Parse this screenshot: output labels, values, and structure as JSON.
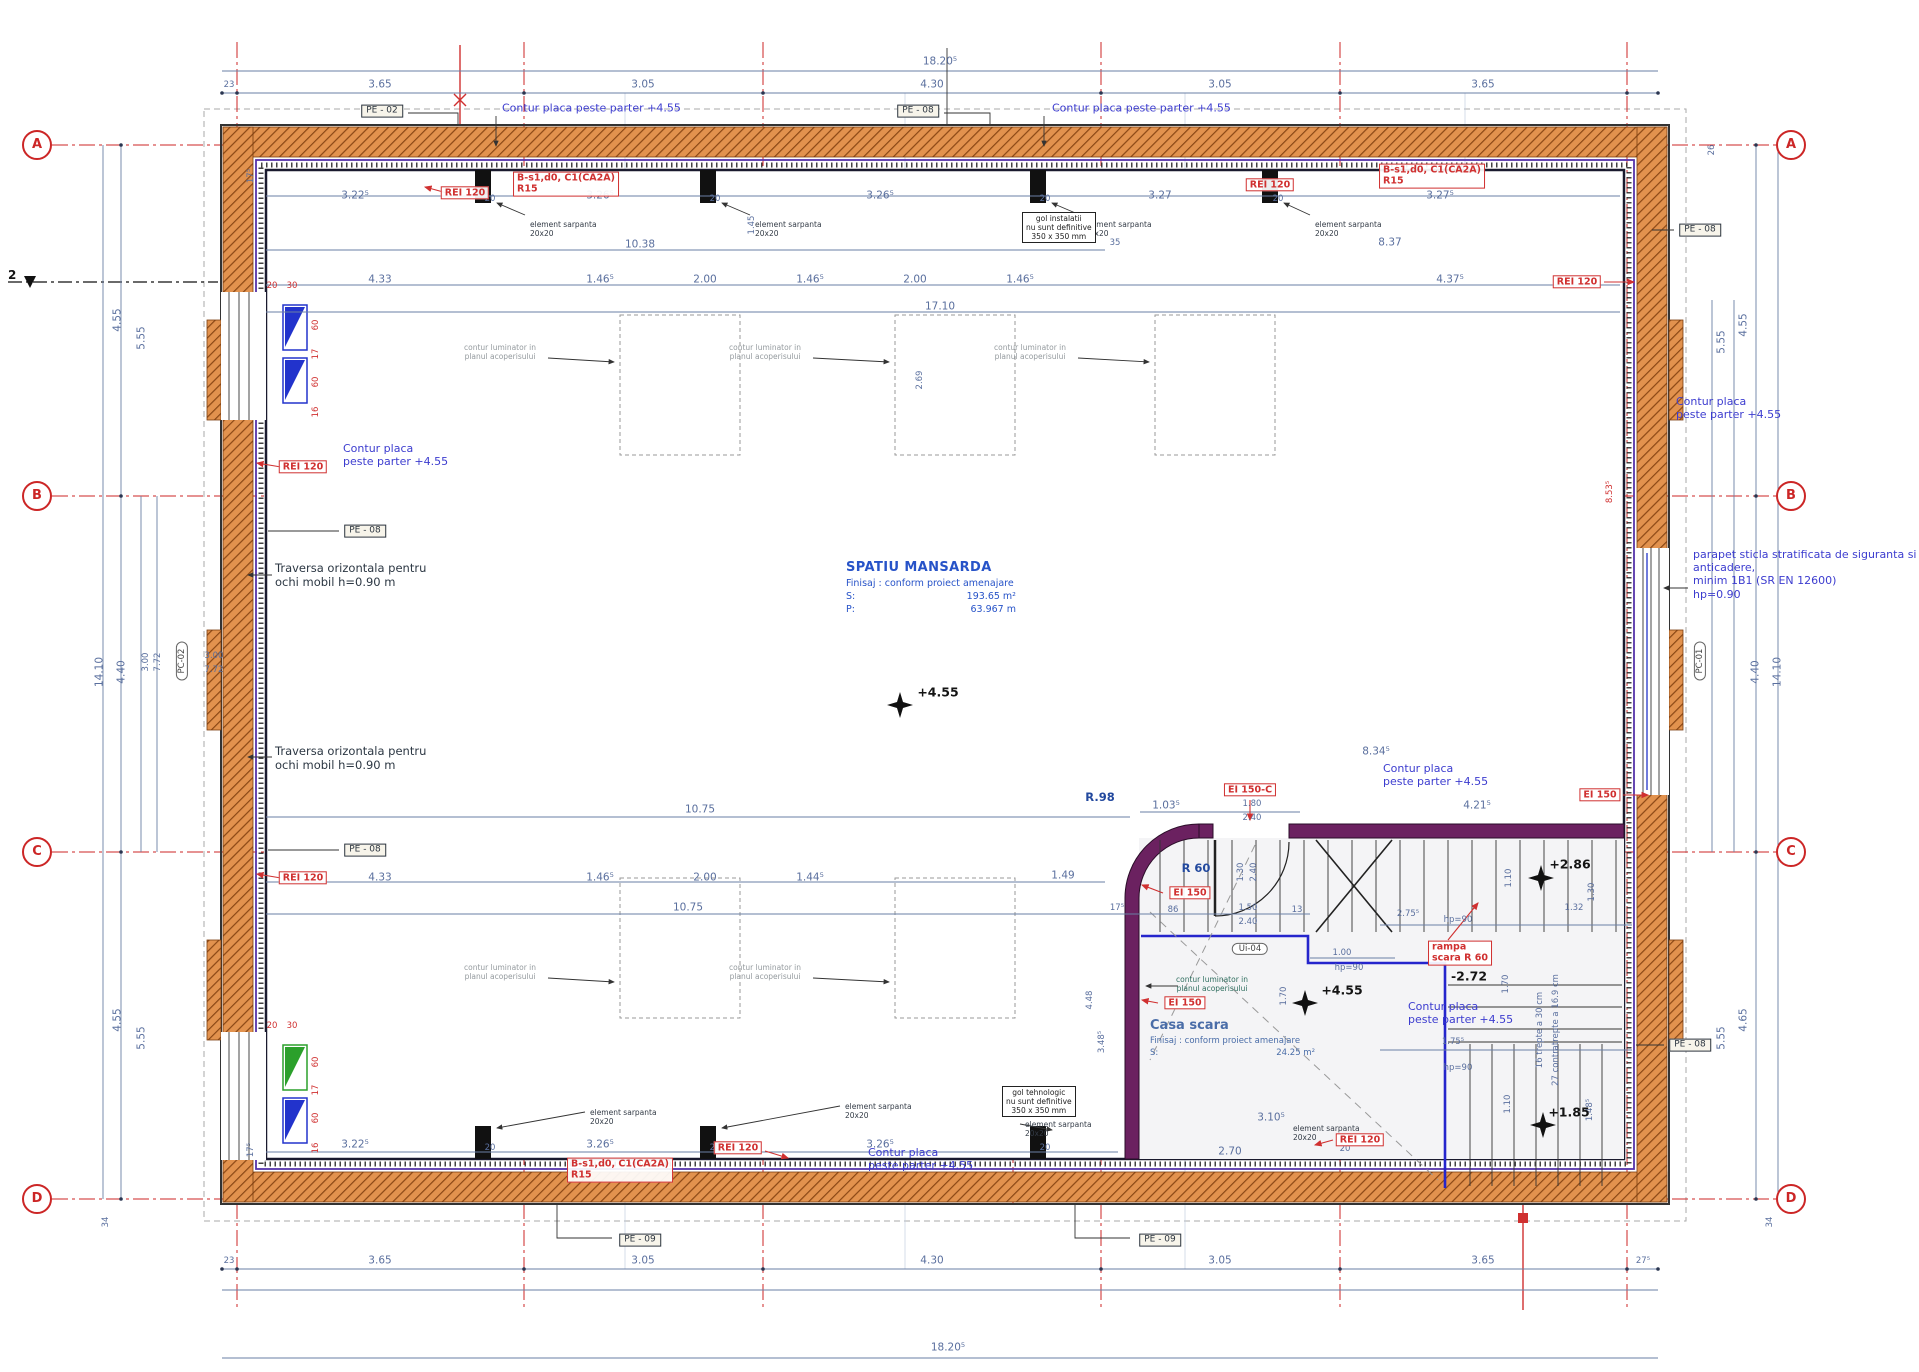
{
  "drawing": {
    "colors": {
      "wall_orange": "#e2924e",
      "wall_hatch": "#8a4715",
      "stair_purple": "#6b2160",
      "stair_blue": "#2525cc",
      "grid_red": "#cc2626",
      "dim_blue": "#5a6f9e",
      "note_blue": "#3c3ccf",
      "label_red": "#d03030"
    },
    "section_marker": {
      "label": "2"
    },
    "rooms": {
      "mansarda": {
        "title": "SPATIU MANSARDA",
        "finish": "Finisaj : conform proiect amenajare",
        "s_label": "S:",
        "s_value": "193.65 m²",
        "p_label": "P:",
        "p_value": "63.967 m"
      },
      "casa_scara": {
        "title": "Casa scara",
        "finish": "Finisaj : conform proiect amenajare",
        "s_label": "S:",
        "s_value": "24.25 m²"
      }
    },
    "grid": {
      "bubbles": [
        {
          "t": "A",
          "x": 37,
          "y": 145
        },
        {
          "t": "A",
          "x": 1791,
          "y": 145
        },
        {
          "t": "B",
          "x": 37,
          "y": 496
        },
        {
          "t": "B",
          "x": 1791,
          "y": 496
        },
        {
          "t": "C",
          "x": 37,
          "y": 852
        },
        {
          "t": "C",
          "x": 1791,
          "y": 852
        },
        {
          "t": "D",
          "x": 37,
          "y": 1199
        },
        {
          "t": "D",
          "x": 1791,
          "y": 1199
        }
      ]
    },
    "levels": [
      {
        "t": "+4.55",
        "x": 938,
        "y": 692
      },
      {
        "t": "+4.55",
        "x": 1342,
        "y": 990
      },
      {
        "t": "+2.86",
        "x": 1570,
        "y": 864
      },
      {
        "t": "+1.85",
        "x": 1569,
        "y": 1112
      },
      {
        "t": "-2.72",
        "x": 1469,
        "y": 976
      }
    ],
    "r_labels": [
      {
        "t": "R 60",
        "x": 1196,
        "y": 869
      },
      {
        "t": "R.98",
        "x": 1100,
        "y": 798
      }
    ],
    "dims": [
      {
        "t": "18.20⁵",
        "x": 940,
        "y": 62
      },
      {
        "t": "23",
        "x": 229,
        "y": 85,
        "c": "sm"
      },
      {
        "t": "3.65",
        "x": 380,
        "y": 85
      },
      {
        "t": "3.05",
        "x": 643,
        "y": 85
      },
      {
        "t": "4.30",
        "x": 932,
        "y": 85
      },
      {
        "t": "3.05",
        "x": 1220,
        "y": 85
      },
      {
        "t": "3.65",
        "x": 1483,
        "y": 85
      },
      {
        "t": "23",
        "x": 229,
        "y": 1261,
        "c": "sm"
      },
      {
        "t": "3.65",
        "x": 380,
        "y": 1261
      },
      {
        "t": "3.05",
        "x": 643,
        "y": 1261
      },
      {
        "t": "4.30",
        "x": 932,
        "y": 1261
      },
      {
        "t": "3.05",
        "x": 1220,
        "y": 1261
      },
      {
        "t": "3.65",
        "x": 1483,
        "y": 1261
      },
      {
        "t": "27⁵",
        "x": 1643,
        "y": 1261,
        "c": "sm"
      },
      {
        "t": "18.20⁵",
        "x": 948,
        "y": 1348
      },
      {
        "t": "4.55",
        "x": 118,
        "y": 320,
        "r": 1
      },
      {
        "t": "5.55",
        "x": 142,
        "y": 338,
        "r": 1
      },
      {
        "t": "14.10",
        "x": 100,
        "y": 672,
        "r": 1
      },
      {
        "t": "4.40",
        "x": 122,
        "y": 672,
        "r": 1
      },
      {
        "t": "3.00",
        "x": 146,
        "y": 662,
        "r": 1,
        "c": "sm"
      },
      {
        "t": "7.72",
        "x": 158,
        "y": 662,
        "r": 1,
        "c": "sm"
      },
      {
        "t": "3.00",
        "x": 214,
        "y": 656,
        "c": "sm"
      },
      {
        "t": "7.72",
        "x": 214,
        "y": 670,
        "c": "sm"
      },
      {
        "t": "4.55",
        "x": 118,
        "y": 1020,
        "r": 1
      },
      {
        "t": "5.55",
        "x": 142,
        "y": 1038,
        "r": 1
      },
      {
        "t": "34",
        "x": 106,
        "y": 1222,
        "r": 1,
        "c": "sm"
      },
      {
        "t": "17⁵",
        "x": 251,
        "y": 176,
        "r": 1,
        "c": "sm"
      },
      {
        "t": "17⁵",
        "x": 251,
        "y": 1150,
        "r": 1,
        "c": "sm"
      },
      {
        "t": "26",
        "x": 1712,
        "y": 150,
        "r": 1,
        "c": "sm"
      },
      {
        "t": "4.55",
        "x": 1744,
        "y": 325,
        "r": 1
      },
      {
        "t": "5.55",
        "x": 1722,
        "y": 342,
        "r": 1
      },
      {
        "t": "14.10",
        "x": 1778,
        "y": 672,
        "r": 1
      },
      {
        "t": "4.40",
        "x": 1756,
        "y": 672,
        "r": 1
      },
      {
        "t": "4.65",
        "x": 1744,
        "y": 1020,
        "r": 1
      },
      {
        "t": "5.55",
        "x": 1722,
        "y": 1038,
        "r": 1
      },
      {
        "t": "34",
        "x": 1770,
        "y": 1222,
        "r": 1,
        "c": "sm"
      },
      {
        "t": "3.22⁵",
        "x": 355,
        "y": 196
      },
      {
        "t": "20",
        "x": 490,
        "y": 199,
        "c": "sm"
      },
      {
        "t": "3.26⁵",
        "x": 600,
        "y": 196
      },
      {
        "t": "20",
        "x": 715,
        "y": 199,
        "c": "sm"
      },
      {
        "t": "3.26⁵",
        "x": 880,
        "y": 196
      },
      {
        "t": "20",
        "x": 1045,
        "y": 199,
        "c": "sm"
      },
      {
        "t": "3.27",
        "x": 1160,
        "y": 196
      },
      {
        "t": "20",
        "x": 1278,
        "y": 199,
        "c": "sm"
      },
      {
        "t": "3.27⁵",
        "x": 1440,
        "y": 196
      },
      {
        "t": "10.38",
        "x": 640,
        "y": 245
      },
      {
        "t": "35",
        "x": 1115,
        "y": 243,
        "c": "sm"
      },
      {
        "t": "8.37",
        "x": 1390,
        "y": 243
      },
      {
        "t": "1.45",
        "x": 752,
        "y": 225,
        "r": 1,
        "c": "sm"
      },
      {
        "t": "4.33",
        "x": 380,
        "y": 280
      },
      {
        "t": "1.46⁵",
        "x": 600,
        "y": 280
      },
      {
        "t": "2.00",
        "x": 705,
        "y": 280
      },
      {
        "t": "1.46⁵",
        "x": 810,
        "y": 280
      },
      {
        "t": "2.00",
        "x": 915,
        "y": 280
      },
      {
        "t": "1.46⁵",
        "x": 1020,
        "y": 280
      },
      {
        "t": "4.37⁵",
        "x": 1450,
        "y": 280
      },
      {
        "t": "17.10",
        "x": 940,
        "y": 307
      },
      {
        "t": "2.69",
        "x": 920,
        "y": 380,
        "r": 1,
        "c": "sm"
      },
      {
        "t": "10.75",
        "x": 700,
        "y": 810
      },
      {
        "t": "10.75",
        "x": 688,
        "y": 908
      },
      {
        "t": "8.34⁵",
        "x": 1376,
        "y": 752
      },
      {
        "t": "4.21⁵",
        "x": 1477,
        "y": 806
      },
      {
        "t": "1.03⁵",
        "x": 1166,
        "y": 806
      },
      {
        "t": "1.80",
        "x": 1252,
        "y": 804,
        "c": "sm"
      },
      {
        "t": "2.40",
        "x": 1252,
        "y": 818,
        "c": "sm"
      },
      {
        "t": "4.33",
        "x": 380,
        "y": 878
      },
      {
        "t": "1.46⁵",
        "x": 600,
        "y": 878
      },
      {
        "t": "2.00",
        "x": 705,
        "y": 878
      },
      {
        "t": "1.44⁵",
        "x": 810,
        "y": 878
      },
      {
        "t": "1.49",
        "x": 1063,
        "y": 876
      },
      {
        "t": "17⁵",
        "x": 1117,
        "y": 908,
        "c": "sm"
      },
      {
        "t": "86",
        "x": 1173,
        "y": 910,
        "c": "sm"
      },
      {
        "t": "1.50",
        "x": 1248,
        "y": 908,
        "c": "sm"
      },
      {
        "t": "2.40",
        "x": 1248,
        "y": 922,
        "c": "sm"
      },
      {
        "t": "13",
        "x": 1297,
        "y": 910,
        "c": "sm"
      },
      {
        "t": "1.30",
        "x": 1241,
        "y": 872,
        "r": 1,
        "c": "sm"
      },
      {
        "t": "2.40",
        "x": 1254,
        "y": 872,
        "r": 1,
        "c": "sm"
      },
      {
        "t": "2.75⁵",
        "x": 1408,
        "y": 914,
        "c": "sm"
      },
      {
        "t": "hp=90",
        "x": 1458,
        "y": 920,
        "c": "sm"
      },
      {
        "t": "1.32",
        "x": 1574,
        "y": 908,
        "c": "sm"
      },
      {
        "t": "1.30",
        "x": 1592,
        "y": 892,
        "r": 1,
        "c": "sm"
      },
      {
        "t": "1.10",
        "x": 1509,
        "y": 878,
        "r": 1,
        "c": "sm"
      },
      {
        "t": "1.00",
        "x": 1342,
        "y": 953,
        "c": "sm"
      },
      {
        "t": "hp=90",
        "x": 1349,
        "y": 968,
        "c": "sm"
      },
      {
        "t": "1.70",
        "x": 1284,
        "y": 996,
        "r": 1,
        "c": "sm"
      },
      {
        "t": "1.70",
        "x": 1506,
        "y": 984,
        "r": 1,
        "c": "sm"
      },
      {
        "t": "4.48",
        "x": 1090,
        "y": 1000,
        "r": 1,
        "c": "sm"
      },
      {
        "t": "3.48⁵",
        "x": 1102,
        "y": 1042,
        "r": 1,
        "c": "sm"
      },
      {
        "t": "1.75⁵",
        "x": 1453,
        "y": 1042,
        "c": "sm"
      },
      {
        "t": "hp=90",
        "x": 1458,
        "y": 1068,
        "c": "sm"
      },
      {
        "t": "1.10",
        "x": 1508,
        "y": 1104,
        "r": 1,
        "c": "sm"
      },
      {
        "t": "1.48⁵",
        "x": 1590,
        "y": 1110,
        "r": 1,
        "c": "sm"
      },
      {
        "t": "27 contratrepte a 16.9 cm",
        "x": 1556,
        "y": 1030,
        "r": 1,
        "c": "sm"
      },
      {
        "t": "16 trepte a 30 cm",
        "x": 1540,
        "y": 1030,
        "r": 1,
        "c": "sm"
      },
      {
        "t": "3.22⁵",
        "x": 355,
        "y": 1145
      },
      {
        "t": "20",
        "x": 490,
        "y": 1148,
        "c": "sm"
      },
      {
        "t": "3.26⁵",
        "x": 600,
        "y": 1145
      },
      {
        "t": "20",
        "x": 715,
        "y": 1148,
        "c": "sm"
      },
      {
        "t": "3.26⁵",
        "x": 880,
        "y": 1145
      },
      {
        "t": "20",
        "x": 1045,
        "y": 1148,
        "c": "sm"
      },
      {
        "t": "3.10⁵",
        "x": 1271,
        "y": 1118
      },
      {
        "t": "2.70",
        "x": 1230,
        "y": 1152
      },
      {
        "t": "20",
        "x": 1345,
        "y": 1149,
        "c": "sm"
      },
      {
        "t": "20",
        "x": 272,
        "y": 286,
        "c": "rd"
      },
      {
        "t": "30",
        "x": 292,
        "y": 286,
        "c": "rd"
      },
      {
        "t": "60",
        "x": 316,
        "y": 325,
        "r": 1,
        "c": "rd"
      },
      {
        "t": "17",
        "x": 316,
        "y": 354,
        "r": 1,
        "c": "rd"
      },
      {
        "t": "60",
        "x": 316,
        "y": 382,
        "r": 1,
        "c": "rd"
      },
      {
        "t": "16",
        "x": 316,
        "y": 412,
        "r": 1,
        "c": "rd"
      },
      {
        "t": "20",
        "x": 272,
        "y": 1026,
        "c": "rd"
      },
      {
        "t": "30",
        "x": 292,
        "y": 1026,
        "c": "rd"
      },
      {
        "t": "60",
        "x": 316,
        "y": 1062,
        "r": 1,
        "c": "rd"
      },
      {
        "t": "17",
        "x": 316,
        "y": 1090,
        "r": 1,
        "c": "rd"
      },
      {
        "t": "60",
        "x": 316,
        "y": 1118,
        "r": 1,
        "c": "rd"
      },
      {
        "t": "16",
        "x": 316,
        "y": 1148,
        "r": 1,
        "c": "rd"
      },
      {
        "t": "8.53⁵",
        "x": 1610,
        "y": 492,
        "r": 1,
        "c": "rd"
      }
    ],
    "red_boxes": [
      {
        "lines": [
          "REI 120"
        ],
        "x": 465,
        "y": 193
      },
      {
        "lines": [
          "B-s1,d0, C1(CA2A)",
          "R15"
        ],
        "x": 566,
        "y": 184
      },
      {
        "lines": [
          "REI 120"
        ],
        "x": 1270,
        "y": 185
      },
      {
        "lines": [
          "B-s1,d0, C1(CA2A)",
          "R15"
        ],
        "x": 1432,
        "y": 176
      },
      {
        "lines": [
          "REI 120"
        ],
        "x": 1577,
        "y": 282
      },
      {
        "lines": [
          "REI 120"
        ],
        "x": 303,
        "y": 467
      },
      {
        "lines": [
          "REI 120"
        ],
        "x": 303,
        "y": 878
      },
      {
        "lines": [
          "EI 150"
        ],
        "x": 1600,
        "y": 795
      },
      {
        "lines": [
          "EI 150-C"
        ],
        "x": 1250,
        "y": 790
      },
      {
        "lines": [
          "EI 150"
        ],
        "x": 1190,
        "y": 893
      },
      {
        "lines": [
          "EI 150"
        ],
        "x": 1185,
        "y": 1003
      },
      {
        "lines": [
          "rampa",
          "scara R 60"
        ],
        "x": 1460,
        "y": 953
      },
      {
        "lines": [
          "REI 120"
        ],
        "x": 738,
        "y": 1148
      },
      {
        "lines": [
          "B-s1,d0, C1(CA2A)",
          "R15"
        ],
        "x": 620,
        "y": 1170
      },
      {
        "lines": [
          "REI 120"
        ],
        "x": 1360,
        "y": 1140
      }
    ],
    "pe_boxes": [
      {
        "t": "PE - 02",
        "x": 382,
        "y": 111
      },
      {
        "t": "PE - 08",
        "x": 918,
        "y": 111
      },
      {
        "t": "PE - 08",
        "x": 1700,
        "y": 230
      },
      {
        "t": "PE - 08",
        "x": 365,
        "y": 531
      },
      {
        "t": "PE - 08",
        "x": 365,
        "y": 850
      },
      {
        "t": "PE - 08",
        "x": 1690,
        "y": 1045
      },
      {
        "t": "PE - 09",
        "x": 640,
        "y": 1240
      },
      {
        "t": "PE - 09",
        "x": 1160,
        "y": 1240
      }
    ],
    "ovals": [
      {
        "t": "PC-02",
        "x": 182,
        "y": 661,
        "r": 1
      },
      {
        "t": "PC-01",
        "x": 1700,
        "y": 661,
        "r": 1
      },
      {
        "t": "Ui-04",
        "x": 1250,
        "y": 949
      }
    ],
    "notes": [
      {
        "lines": [
          "Contur placa peste parter +4.55"
        ],
        "x": 502,
        "y": 108,
        "c": "nblue",
        "a": "l"
      },
      {
        "lines": [
          "Contur placa peste parter +4.55"
        ],
        "x": 1052,
        "y": 108,
        "c": "nblue",
        "a": "l"
      },
      {
        "lines": [
          "Contur placa",
          "peste parter +4.55"
        ],
        "x": 343,
        "y": 442,
        "c": "nblue",
        "a": "tl"
      },
      {
        "lines": [
          "Contur placa",
          "peste parter +4.55"
        ],
        "x": 1676,
        "y": 395,
        "c": "nblue",
        "a": "tl"
      },
      {
        "lines": [
          "Contur placa",
          "peste parter +4.55"
        ],
        "x": 1383,
        "y": 762,
        "c": "nblue",
        "a": "tl"
      },
      {
        "lines": [
          "Contur placa",
          "peste parter +4.55"
        ],
        "x": 1408,
        "y": 1000,
        "c": "nblue",
        "a": "tl"
      },
      {
        "lines": [
          "Contur placa",
          "peste parter +4.55"
        ],
        "x": 868,
        "y": 1146,
        "c": "nblue",
        "a": "tl"
      },
      {
        "lines": [
          "parapet sticla stratificata de siguranta si",
          "anticadere,",
          "minim 1B1 (SR EN 12600)",
          "hp=0.90"
        ],
        "x": 1693,
        "y": 548,
        "c": "nblue sm2",
        "a": "tl"
      },
      {
        "lines": [
          "Traversa orizontala pentru",
          "ochi mobil h=0.90 m"
        ],
        "x": 275,
        "y": 562,
        "c": "ndark",
        "a": "tl"
      },
      {
        "lines": [
          "Traversa orizontala pentru",
          "ochi mobil h=0.90 m"
        ],
        "x": 275,
        "y": 745,
        "c": "ndark",
        "a": "tl"
      },
      {
        "lines": [
          "element sarpanta",
          "20x20"
        ],
        "x": 530,
        "y": 220,
        "c": "ntiny",
        "a": "tl"
      },
      {
        "lines": [
          "element sarpanta",
          "20x20"
        ],
        "x": 755,
        "y": 220,
        "c": "ntiny",
        "a": "tl"
      },
      {
        "lines": [
          "element sarpanta",
          "20x20"
        ],
        "x": 1085,
        "y": 220,
        "c": "ntiny",
        "a": "tl"
      },
      {
        "lines": [
          "element sarpanta",
          "20x20"
        ],
        "x": 1315,
        "y": 220,
        "c": "ntiny",
        "a": "tl"
      },
      {
        "lines": [
          "element sarpanta",
          "20x20"
        ],
        "x": 590,
        "y": 1108,
        "c": "ntiny",
        "a": "tl"
      },
      {
        "lines": [
          "element sarpanta",
          "20x20"
        ],
        "x": 845,
        "y": 1102,
        "c": "ntiny",
        "a": "tl"
      },
      {
        "lines": [
          "element sarpanta",
          "20x20"
        ],
        "x": 1025,
        "y": 1120,
        "c": "ntiny",
        "a": "tl"
      },
      {
        "lines": [
          "element sarpanta",
          "20x20"
        ],
        "x": 1293,
        "y": 1124,
        "c": "ntiny",
        "a": "tl"
      },
      {
        "lines": [
          "contur luminator in",
          "planul acoperisului"
        ],
        "x": 500,
        "y": 352,
        "c": "ngray"
      },
      {
        "lines": [
          "contur luminator in",
          "planul acoperisului"
        ],
        "x": 765,
        "y": 352,
        "c": "ngray"
      },
      {
        "lines": [
          "contur luminator in",
          "planul acoperisului"
        ],
        "x": 1030,
        "y": 352,
        "c": "ngray"
      },
      {
        "lines": [
          "contur luminator in",
          "planul acoperisului"
        ],
        "x": 500,
        "y": 972,
        "c": "ngray"
      },
      {
        "lines": [
          "contur luminator in",
          "planul acoperisului"
        ],
        "x": 765,
        "y": 972,
        "c": "ngray"
      },
      {
        "lines": [
          "contur luminator in",
          "planul acoperisului"
        ],
        "x": 1212,
        "y": 984,
        "c": "nteal"
      },
      {
        "lines": [
          "gol instalatii",
          "nu sunt definitive",
          "350 x 350 mm"
        ],
        "x": 1022,
        "y": 212,
        "c": "nbox",
        "a": "tl"
      },
      {
        "lines": [
          "gol tehnologic",
          "nu sunt definitive",
          "350 x 350 mm"
        ],
        "x": 1002,
        "y": 1086,
        "c": "nbox",
        "a": "tl"
      }
    ]
  }
}
